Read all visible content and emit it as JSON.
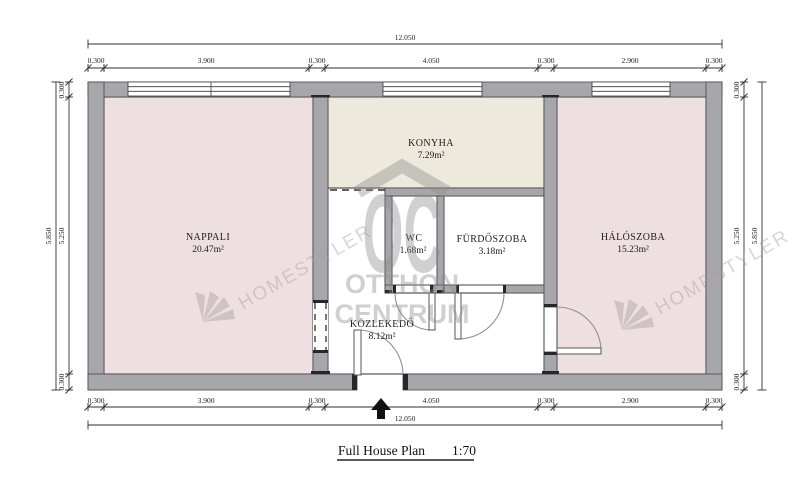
{
  "plan": {
    "title": "Full House Plan",
    "scale": "1:70",
    "rooms": [
      {
        "name": "NAPPALI",
        "area": "20.47m²"
      },
      {
        "name": "KONYHA",
        "area": "7.29m²"
      },
      {
        "name": "WC",
        "area": "1.68m²"
      },
      {
        "name": "FÜRDŐSZOBA",
        "area": "3.18m²"
      },
      {
        "name": "HÁLÓSZOBA",
        "area": "15.23m²"
      },
      {
        "name": "KÖZLEKEDŐ",
        "area": "8.12m²"
      }
    ]
  },
  "dimensions": {
    "top": {
      "total": "12.050",
      "chain": [
        "0.300",
        "3.900",
        "0.300",
        "4.050",
        "0.300",
        "2.900",
        "0.300"
      ]
    },
    "bottom": {
      "total": "12.050",
      "chain": [
        "0.300",
        "3.900",
        "0.300",
        "4.050",
        "0.300",
        "2.900",
        "0.300"
      ]
    },
    "left": {
      "total": "5.850",
      "chain": [
        "0.300",
        "5.250",
        "0.300"
      ]
    },
    "right": {
      "total": "5.850",
      "chain": [
        "0.300",
        "5.250",
        "0.300"
      ]
    }
  },
  "watermarks": {
    "homestyler_left": "HOMESTYLER",
    "homestyler_right": "HOMESTYLER",
    "logo_initials": "OC",
    "logo_line1": "OTTHON",
    "logo_line2": "CENTRUM"
  },
  "colors": {
    "wall": "#a7a7ab",
    "room_pink": "#eee0e1",
    "room_cream": "#edeadd",
    "room_white": "#ffffff",
    "watermark_gray": "#8c8c8c",
    "watermark_pink": "#a89d9e"
  }
}
